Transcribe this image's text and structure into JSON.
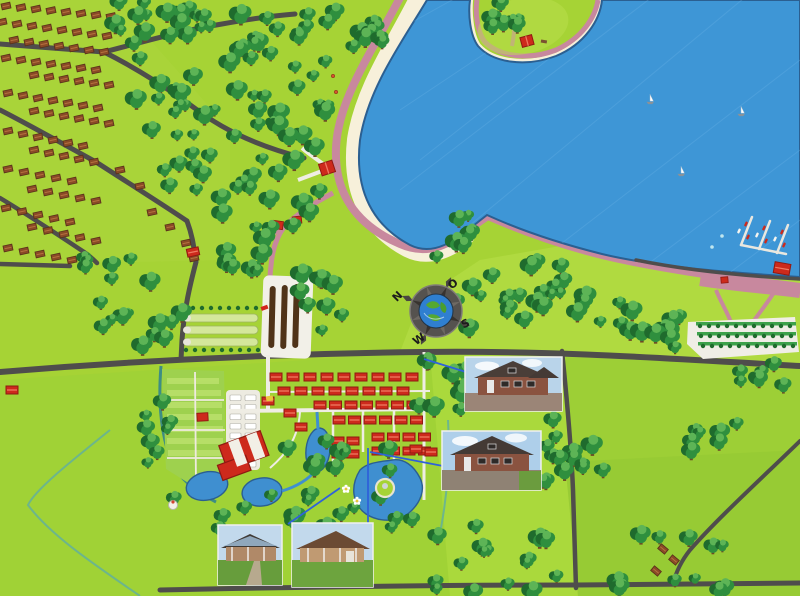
{
  "map": {
    "title": "Illustrated holiday resort park overview map",
    "width": 800,
    "height": 596
  },
  "compass": {
    "north": "N",
    "east": "O",
    "south": "S",
    "west": "W"
  },
  "photo_insets": [
    {
      "id": "inset-villa-upper",
      "desc": "two-storey brick holiday villa"
    },
    {
      "id": "inset-villa-lower",
      "desc": "brick holiday villa with driveway"
    },
    {
      "id": "inset-bungalow-left",
      "desc": "single-storey bungalow with garden path"
    },
    {
      "id": "inset-bungalow-right",
      "desc": "single-storey bungalow with veranda"
    }
  ],
  "features": [
    "lake",
    "sandy-beach",
    "beach-pavilion",
    "peninsula",
    "marina",
    "sailboats",
    "shore-promenade",
    "parking-lot",
    "holiday-park",
    "campground",
    "caravan-field",
    "bungalow-grid",
    "central-facility",
    "ponds",
    "play-island",
    "greenhouses",
    "farm-sheds",
    "residential-village",
    "forest",
    "fields",
    "compass-rose"
  ],
  "colors": {
    "grass": "#a6d335",
    "grass_light": "#b9e04e",
    "field_bright": "#b0da40",
    "forest_dark": "#1f6b2d",
    "forest_mid": "#2f8f3e",
    "forest_light": "#5db456",
    "trunk": "#6d4a26",
    "water": "#3e96d6",
    "water_edge": "#2b5f91",
    "pond": "#3f8fd0",
    "sand": "#f7f0da",
    "path_pink": "#c8889e",
    "road": "#4f4d4c",
    "path_white": "#efede4",
    "roof_red": "#cd2a1c",
    "roof_red_dark": "#8f1a12",
    "roof_red_ridge": "#ef7a62",
    "house_brown": "#8a4a26",
    "house_brown_dark": "#58301a",
    "house_brown_ridge": "#b5713f",
    "canal": "#3e8d84",
    "ditch": "#63b09b",
    "leader": "#2f62d9",
    "barn": "#4f3318",
    "greenhouse": "#d4e79b"
  },
  "forest_patches": [
    [
      115,
      0,
      110,
      52,
      18
    ],
    [
      128,
      58,
      110,
      58,
      16
    ],
    [
      238,
      0,
      100,
      68,
      18
    ],
    [
      242,
      72,
      96,
      76,
      16
    ],
    [
      150,
      122,
      100,
      96,
      16
    ],
    [
      248,
      152,
      82,
      92,
      14
    ],
    [
      335,
      10,
      48,
      42,
      8
    ],
    [
      480,
      2,
      44,
      26,
      7
    ],
    [
      75,
      255,
      108,
      100,
      18
    ],
    [
      215,
      250,
      85,
      22,
      8
    ],
    [
      298,
      262,
      46,
      92,
      9
    ],
    [
      450,
      262,
      122,
      68,
      22
    ],
    [
      575,
      293,
      68,
      40,
      9
    ],
    [
      655,
      303,
      38,
      45,
      7
    ],
    [
      428,
      216,
      52,
      42,
      7
    ],
    [
      145,
      352,
      30,
      122,
      8
    ],
    [
      418,
      350,
      48,
      86,
      10
    ],
    [
      533,
      406,
      45,
      80,
      9
    ],
    [
      285,
      438,
      148,
      86,
      13
    ],
    [
      162,
      494,
      255,
      38,
      14
    ],
    [
      420,
      523,
      142,
      70,
      16
    ],
    [
      618,
      533,
      112,
      58,
      12
    ],
    [
      688,
      416,
      52,
      40,
      7
    ],
    [
      700,
      360,
      95,
      30,
      7
    ],
    [
      562,
      430,
      42,
      44,
      6
    ]
  ],
  "residential_rows": [
    [
      6,
      6,
      8,
      15,
      1.5
    ],
    [
      2,
      22,
      8,
      15,
      2
    ],
    [
      14,
      40,
      7,
      15,
      2
    ],
    [
      6,
      58,
      7,
      15,
      2
    ],
    [
      34,
      75,
      6,
      15,
      2
    ],
    [
      8,
      93,
      7,
      15,
      2.5
    ],
    [
      34,
      111,
      6,
      15,
      2.5
    ],
    [
      8,
      131,
      6,
      15,
      3
    ],
    [
      34,
      150,
      5,
      15,
      3
    ],
    [
      8,
      169,
      5,
      16,
      3
    ],
    [
      32,
      189,
      5,
      16,
      3
    ],
    [
      6,
      208,
      5,
      16,
      3.5
    ],
    [
      32,
      227,
      5,
      16,
      3.5
    ],
    [
      8,
      248,
      5,
      16,
      3
    ]
  ],
  "extra_brown_houses": [
    [
      152,
      212,
      -12
    ],
    [
      170,
      227,
      -12
    ],
    [
      186,
      243,
      -12
    ],
    [
      194,
      258,
      -12
    ],
    [
      120,
      170,
      -12
    ],
    [
      140,
      186,
      -12
    ],
    [
      663,
      549,
      40
    ],
    [
      674,
      560,
      40
    ],
    [
      656,
      571,
      40
    ]
  ],
  "bungalow_blocks": [
    [
      276,
      377,
      9,
      1,
      17,
      0
    ],
    [
      284,
      391,
      8,
      1,
      17,
      0
    ],
    [
      320,
      405,
      7,
      1,
      15.5,
      0
    ],
    [
      339,
      420,
      6,
      1,
      15.5,
      0
    ],
    [
      378,
      437,
      4,
      2,
      15.5,
      14
    ],
    [
      338,
      441,
      2,
      2,
      15,
      13
    ]
  ],
  "bungalow_singles": [
    [
      290,
      413,
      0
    ],
    [
      301,
      427,
      0
    ],
    [
      268,
      401,
      0
    ],
    [
      416,
      449,
      0
    ],
    [
      431,
      452,
      0
    ],
    [
      193,
      252,
      -12
    ],
    [
      12,
      390,
      0
    ]
  ],
  "sailboats": [
    [
      650,
      100
    ],
    [
      741,
      112
    ],
    [
      681,
      172
    ]
  ],
  "marina_boats": {
    "red": [
      [
        746,
        224
      ],
      [
        764,
        228
      ],
      [
        782,
        232
      ],
      [
        748,
        237
      ],
      [
        766,
        241
      ],
      [
        784,
        245
      ]
    ],
    "white": [
      [
        739,
        231
      ],
      [
        757,
        235
      ],
      [
        775,
        239
      ]
    ],
    "dinghy": [
      [
        722,
        236
      ],
      [
        712,
        247
      ]
    ]
  },
  "bush_rows": [
    [
      184,
      308,
      9,
      9
    ],
    [
      186,
      350,
      9,
      9
    ],
    [
      700,
      326,
      11,
      9
    ],
    [
      701,
      336,
      11,
      9
    ],
    [
      703,
      346,
      11,
      9
    ]
  ],
  "caravans": {
    "cols": [
      230,
      245
    ],
    "y0": 395,
    "rows": 8,
    "dy": 9.5,
    "w": 11,
    "h": 5.5
  }
}
